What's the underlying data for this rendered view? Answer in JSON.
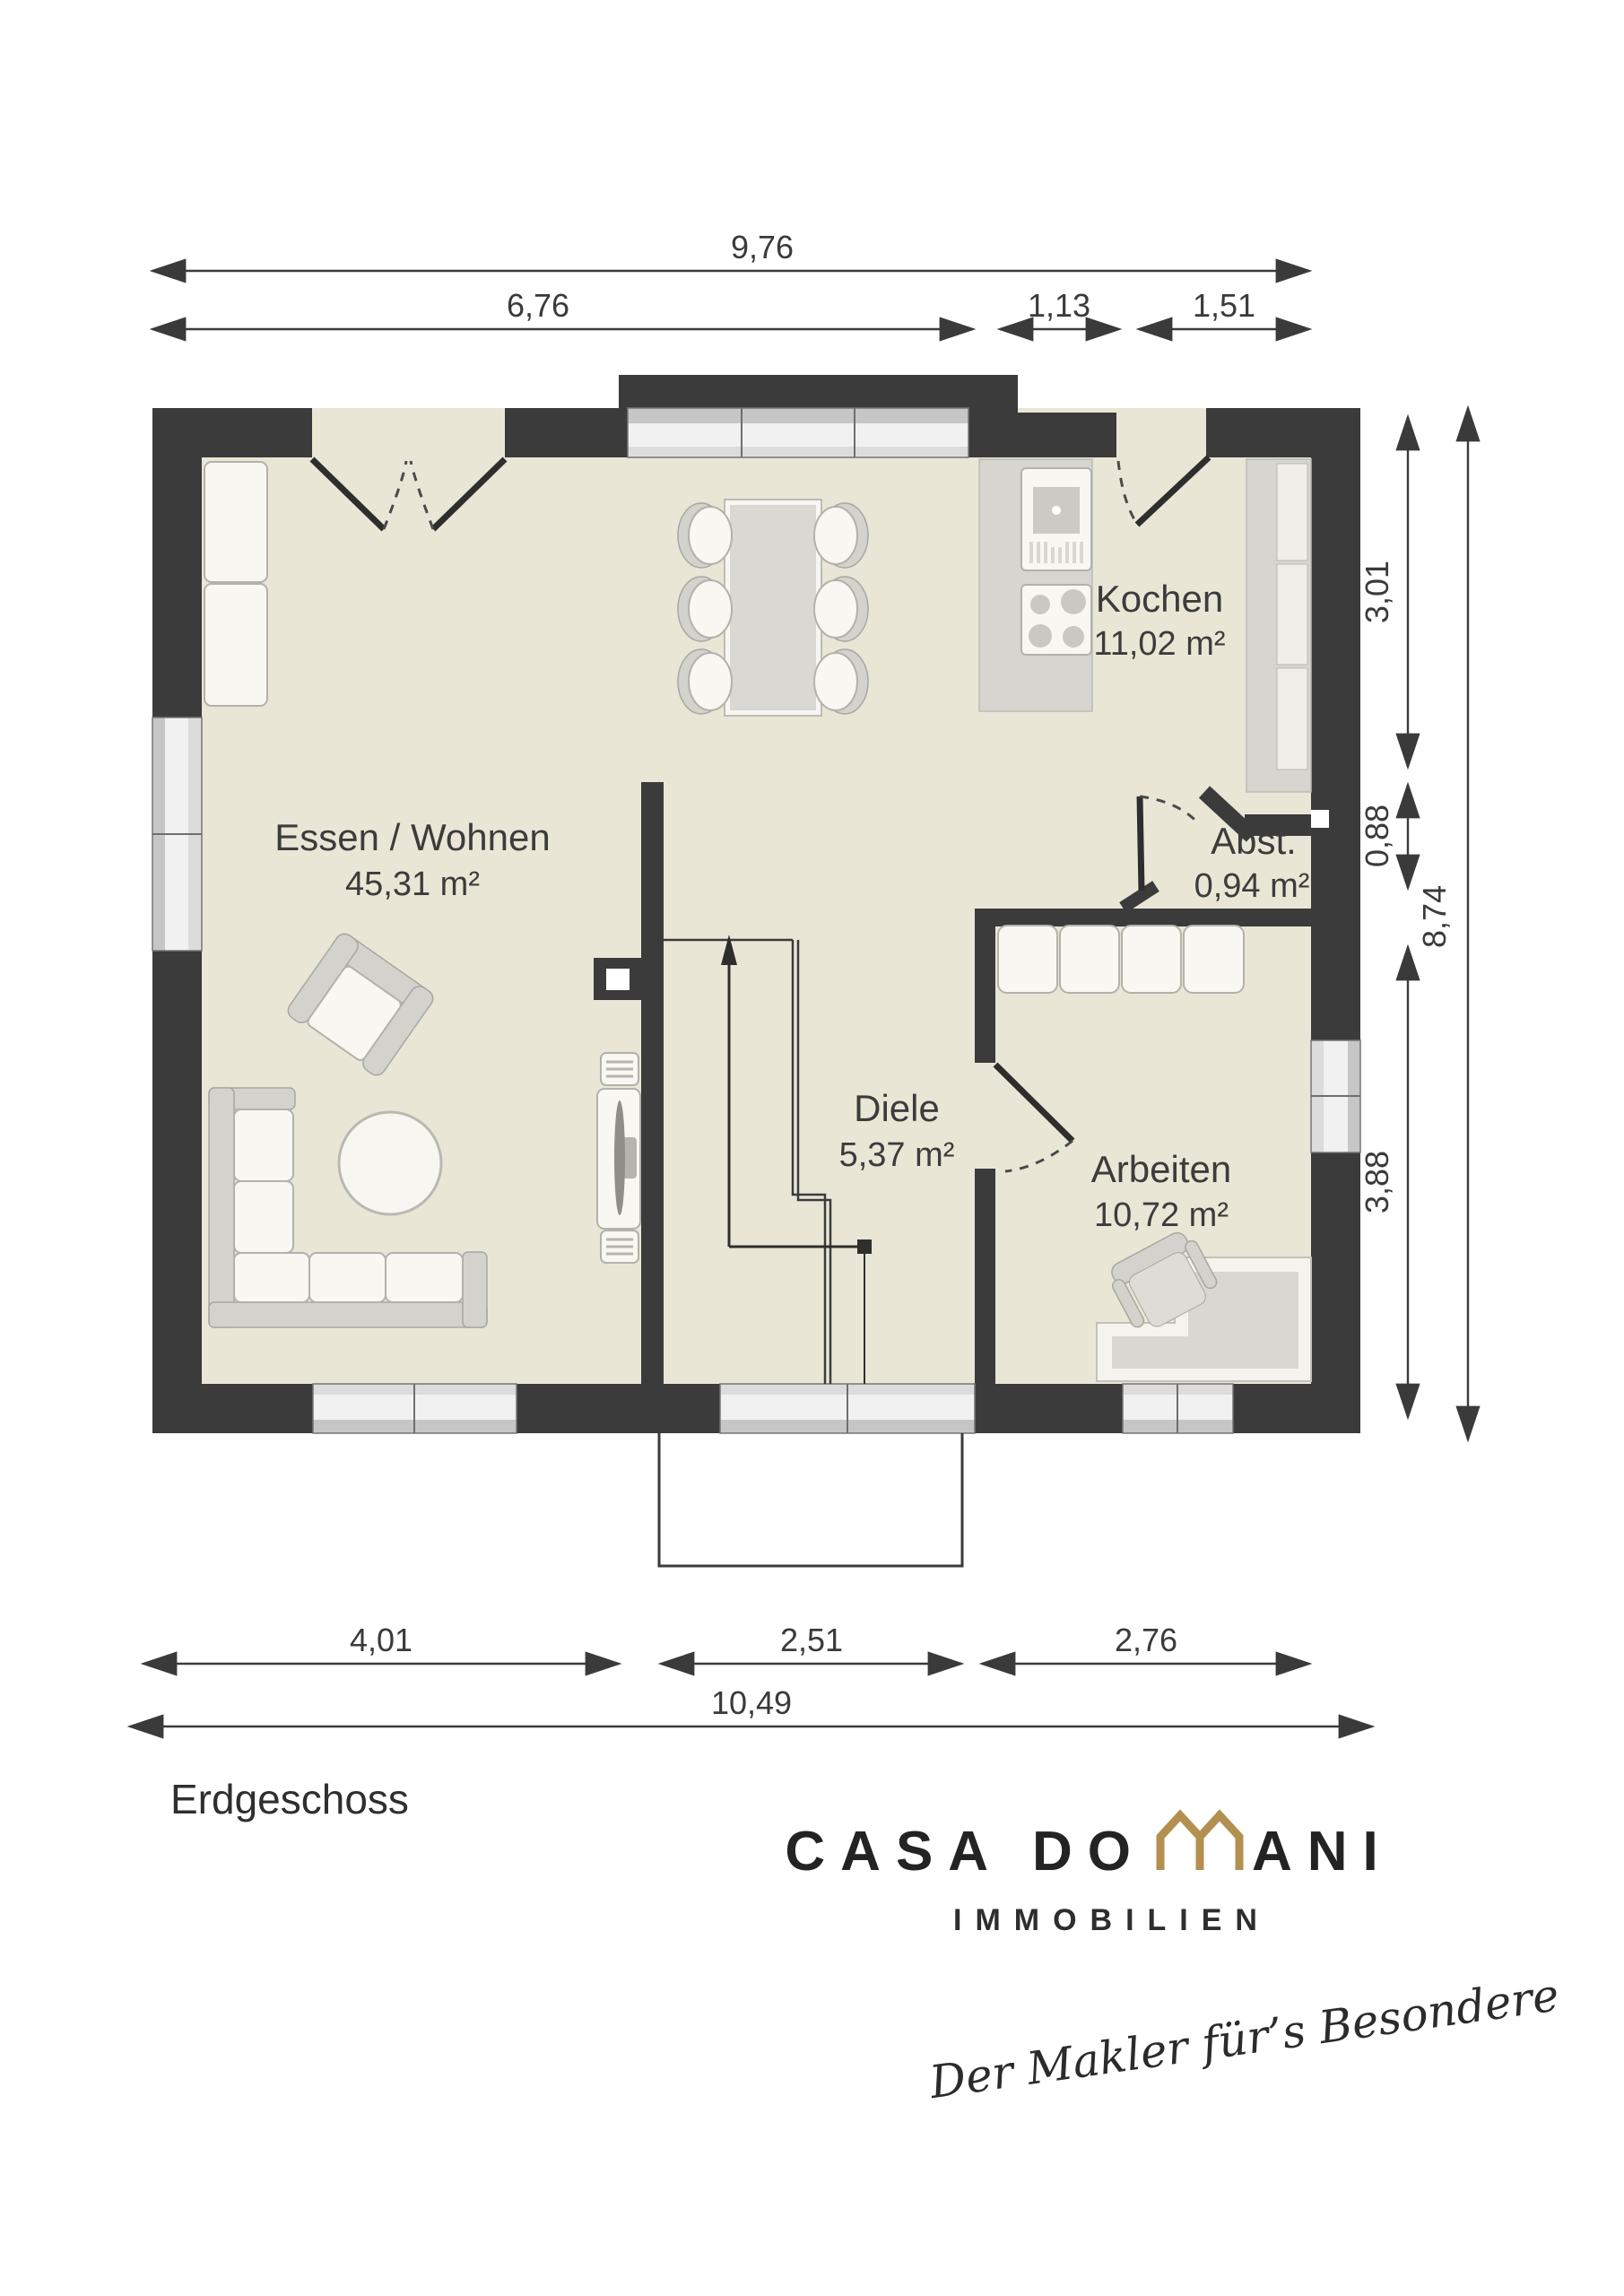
{
  "plan": {
    "floor_label": "Erdgeschoss",
    "rooms": [
      {
        "name": "Essen / Wohnen",
        "area": "45,31 m²"
      },
      {
        "name": "Kochen",
        "area": "11,02 m²"
      },
      {
        "name": "Abst.",
        "area": "0,94 m²"
      },
      {
        "name": "Diele",
        "area": "5,37 m²"
      },
      {
        "name": "Arbeiten",
        "area": "10,72 m²"
      }
    ],
    "dimensions": {
      "top": {
        "total": "9,76",
        "segments": [
          "6,76",
          "1,13",
          "1,51"
        ]
      },
      "right": {
        "total": "8,74",
        "segments": [
          "3,01",
          "0,88",
          "3,88"
        ]
      },
      "bottom": {
        "total": "10,49",
        "segments": [
          "4,01",
          "2,51",
          "2,76"
        ]
      }
    }
  },
  "branding": {
    "brand_left": "CASA DO",
    "brand_right": "ANI",
    "division": "IMMOBILIEN",
    "tagline": "Der Makler für’s Besondere"
  },
  "colors": {
    "accent": "#b3904f",
    "wall": "#3b3b3b",
    "floor": "#eae6d6",
    "text": "#3a3a3a"
  }
}
